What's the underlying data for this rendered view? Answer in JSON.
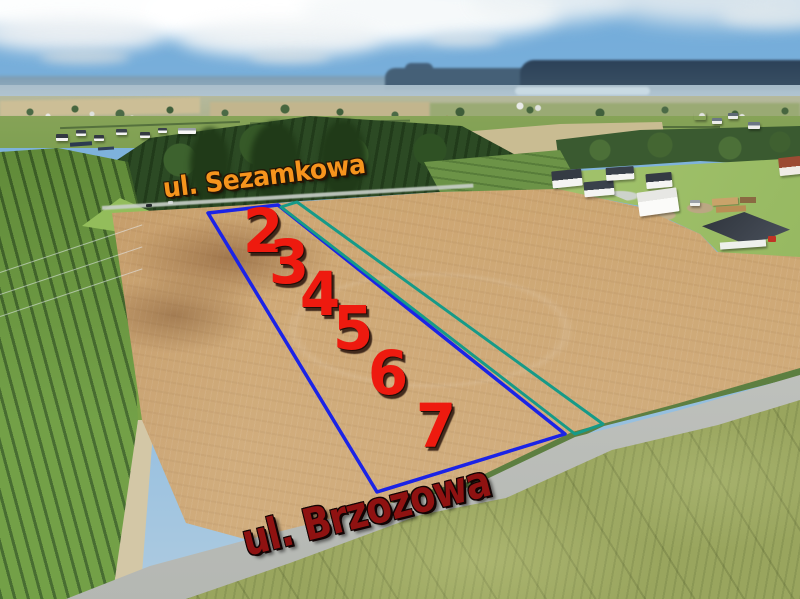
{
  "street_labels": {
    "top_road": {
      "text": "ul. Sezamkowa",
      "color": "#f6941d"
    },
    "bottom_road": {
      "text": "ul. Brzozowa",
      "color": "#8f1211"
    }
  },
  "plot_numbers": {
    "color": "#ee1a0f",
    "items": [
      {
        "label": "2",
        "x": 263,
        "y": 231
      },
      {
        "label": "3",
        "x": 289,
        "y": 262
      },
      {
        "label": "4",
        "x": 320,
        "y": 294
      },
      {
        "label": "5",
        "x": 353,
        "y": 328
      },
      {
        "label": "6",
        "x": 388,
        "y": 373
      },
      {
        "label": "7",
        "x": 436,
        "y": 426
      }
    ]
  },
  "parcel_outlines": [
    {
      "id": "parcel-outline-blue",
      "color": "#1b23e6",
      "stroke_width": 3.5,
      "points": "208,213 278,205 565,434 377,492"
    },
    {
      "id": "parcel-outline-teal",
      "color": "#169a88",
      "stroke_width": 3,
      "points": "281,207 297,202 603,424 575,434"
    }
  ]
}
